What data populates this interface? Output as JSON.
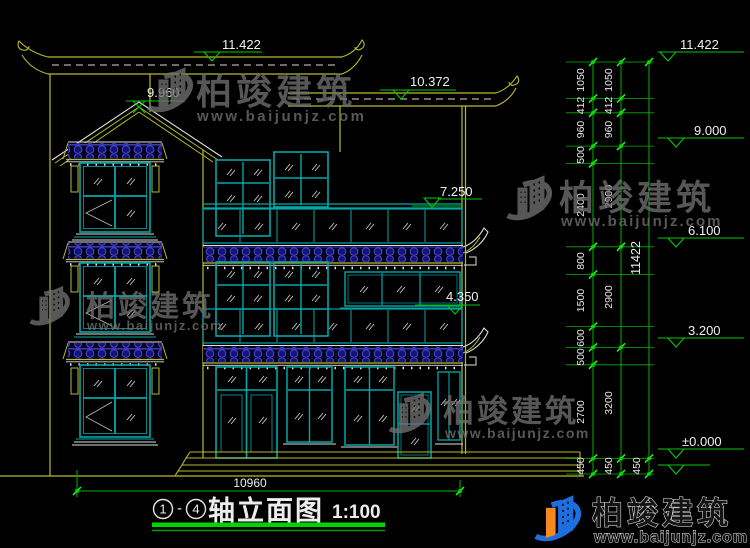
{
  "title_block": {
    "axis_start": "1",
    "separator": "-",
    "axis_end": "4",
    "title": "轴立面图",
    "scale": "1:100"
  },
  "elevation_markers": {
    "building": {
      "top_roof": "11.422",
      "second_roof": "10.372",
      "gable_peak": "9.960",
      "third_floor": "7.250",
      "second_floor": "4.350"
    },
    "right": {
      "top": "11.422",
      "level_9": "9.000",
      "level_6": "6.100",
      "level_3": "3.200",
      "ground": "±0.000"
    }
  },
  "dimensions": {
    "chain_a": [
      "1050",
      "412",
      "960",
      "500",
      "2400",
      "800",
      "1500",
      "600",
      "500",
      "2700",
      "450"
    ],
    "chain_b": [
      "1050",
      "412",
      "960",
      "2900",
      "2900",
      "3200",
      "450"
    ],
    "total_height": "11422",
    "chain_c_plinth": "450",
    "total_width": "10960"
  },
  "watermark": {
    "brand": "柏竣建筑",
    "url": "www.baijunjz.com"
  },
  "footer": {
    "brand": "柏竣建筑",
    "url": "www.baijunjz.com"
  }
}
